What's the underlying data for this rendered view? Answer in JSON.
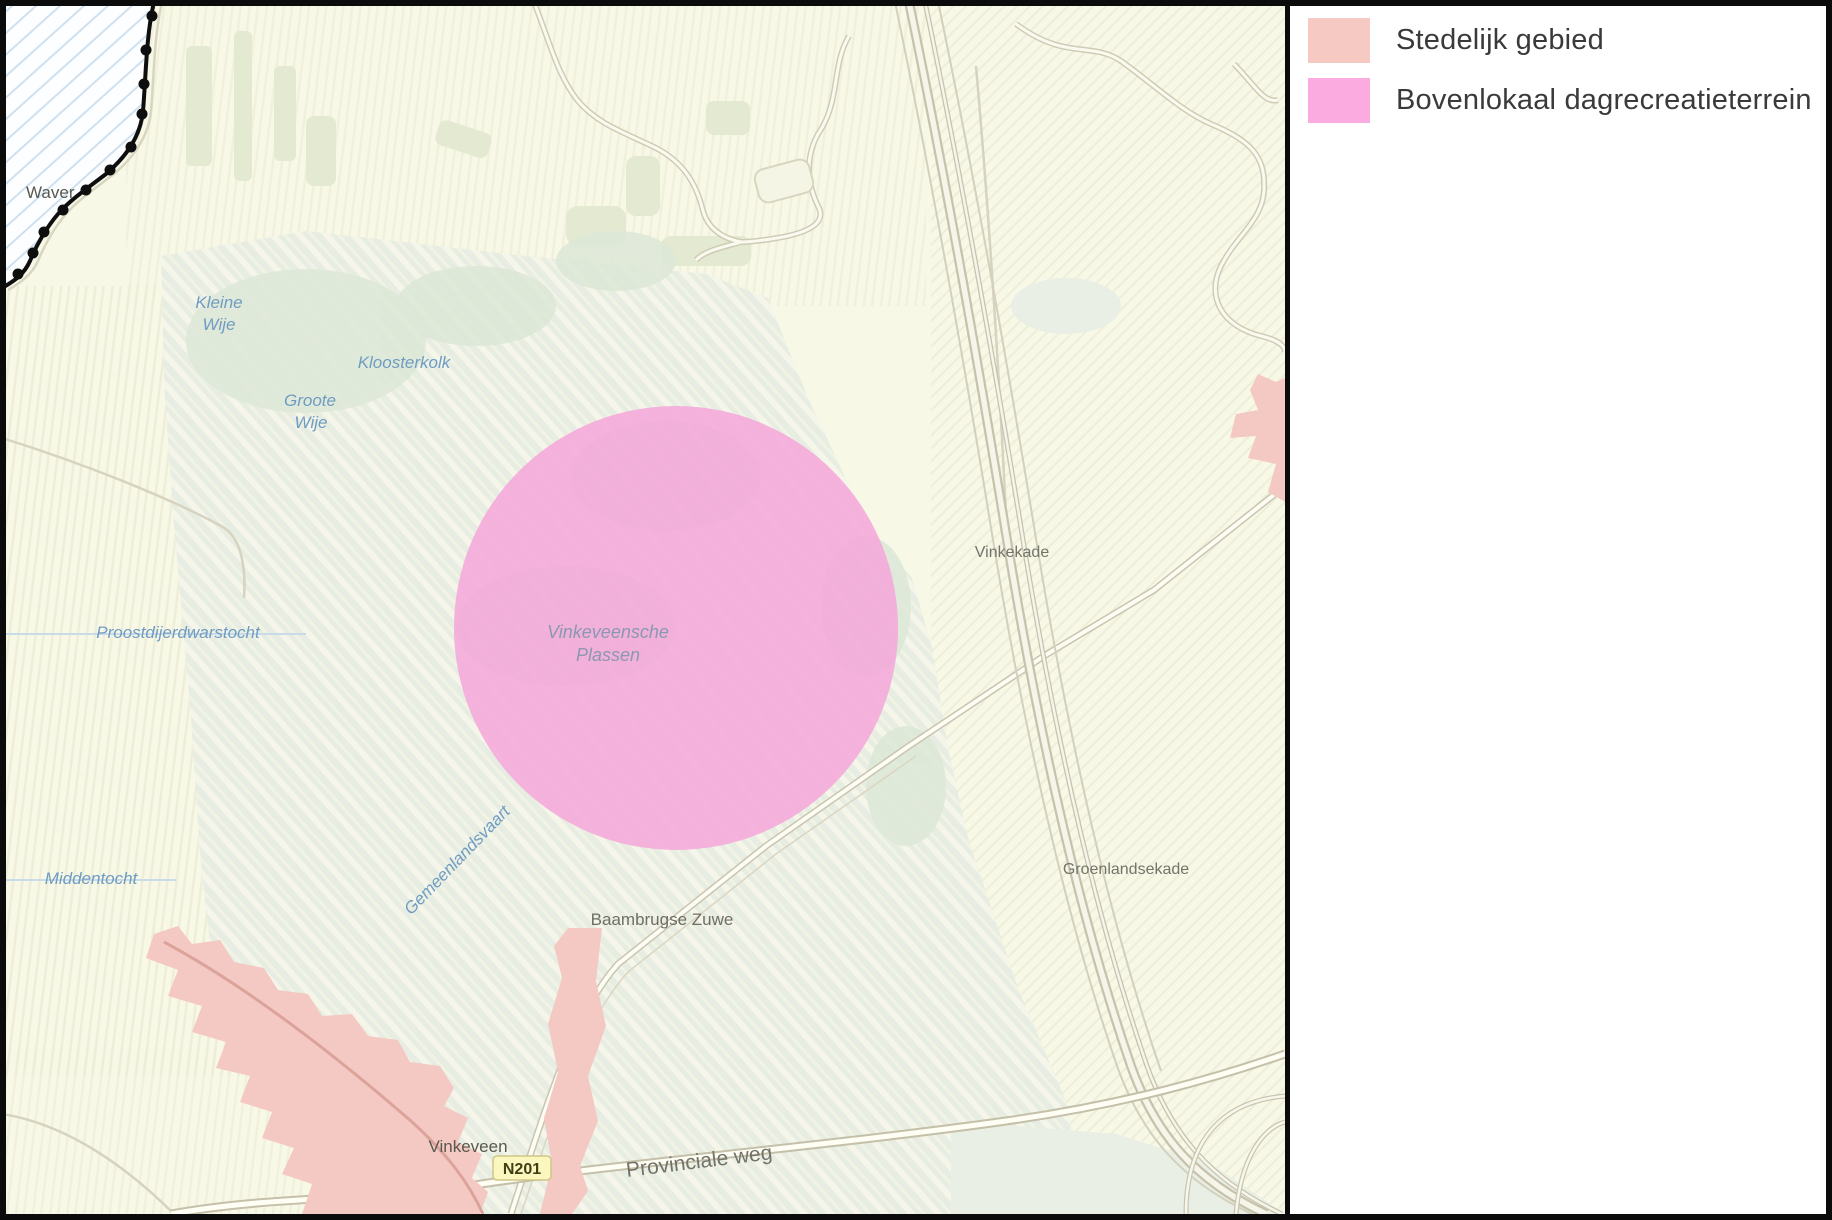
{
  "legend": {
    "items": [
      {
        "label": "Stedelijk gebied",
        "color": "#f6c9c3"
      },
      {
        "label": "Bovenlokaal dagrecreatieterrein",
        "color": "#fbabdf"
      }
    ]
  },
  "map": {
    "labels": {
      "waver": "Waver",
      "kleine_wije_line1": "Kleine",
      "kleine_wije_line2": "Wije",
      "kloosterkolk": "Kloosterkolk",
      "groote_wije_line1": "Groote",
      "groote_wije_line2": "Wije",
      "proostdijerdwarstocht": "Proostdijerdwarstocht",
      "middentocht": "Middentocht",
      "gemeenlandsvaart": "Gemeenlandsvaart",
      "vinkeveensche_plassen_line1": "Vinkeveensche",
      "vinkeveensche_plassen_line2": "Plassen",
      "vinkekade": "Vinkekade",
      "groenlandsekade": "Groenlandsekade",
      "baambrugse_zuwe": "Baambrugse Zuwe",
      "vinkeveen": "Vinkeveen",
      "provinciale_weg": "Provinciale weg"
    },
    "road_badge": {
      "text": "N201",
      "bg": "#fcf6bf"
    },
    "overlay_circle_color": "#f5a6d9",
    "urban_color": "#f5c9c3",
    "background_color": "#f8f8e7",
    "wetland_color": "#e7ede2"
  }
}
